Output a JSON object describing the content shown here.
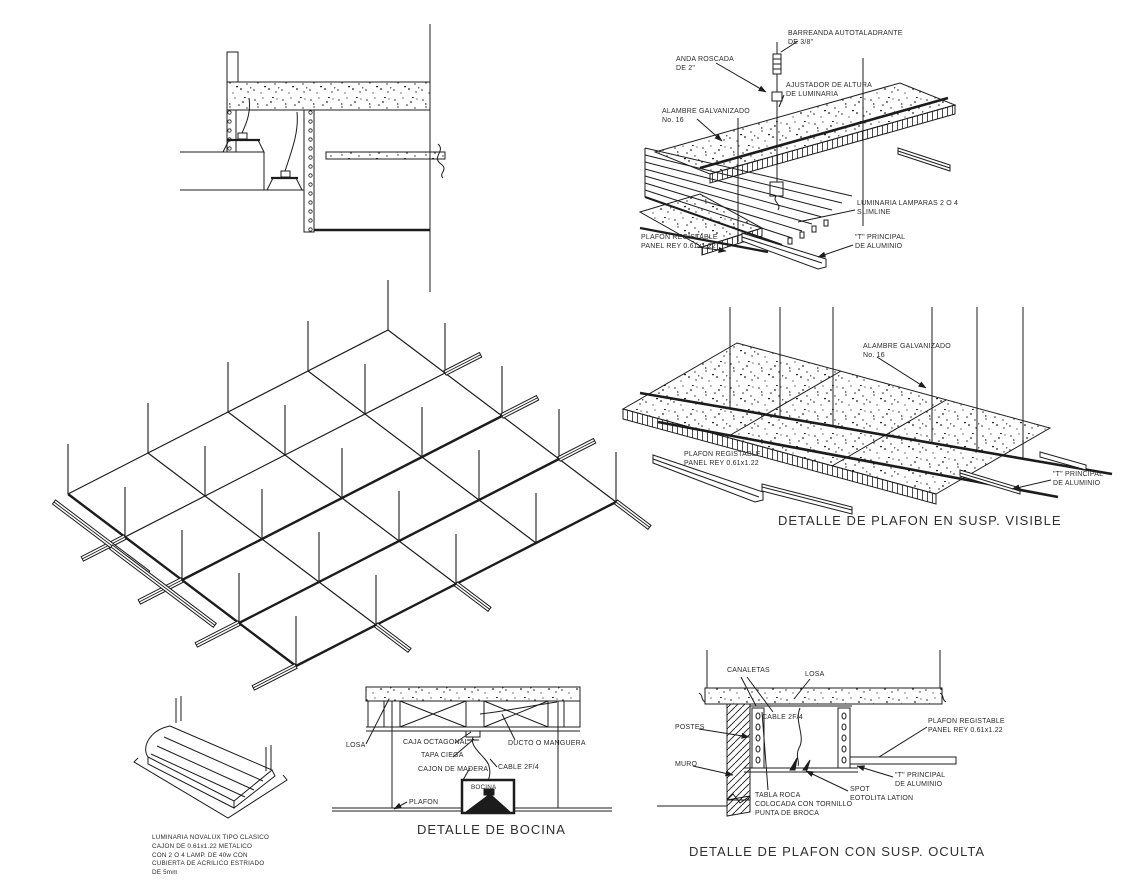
{
  "document": {
    "kind": "CAD ceiling construction details sheet (plafones)",
    "background": "#ffffff",
    "ink": "#1c1c1c"
  },
  "details": {
    "suspension_luminaria": {
      "labels": {
        "barrena": "BARREANDA AUTOTALADRANTE\nDE 3/8\"",
        "anda_roscada": "ANDA ROSCADA\nDE 2\"",
        "ajustador": "AJUSTADOR DE ALTURA\nDE LUMINARIA",
        "alambre": "ALAMBRE GALVANIZADO\nNo. 16",
        "luminaria_lamparas": "LUMINARIA LAMPARAS 2 O 4\nSLIMLINE",
        "plafon": "PLAFON REGISTABLE\nPANEL REY 0.61x1.22",
        "t_principal": "\"T\" PRINCIPAL\nDE ALUMINIO"
      }
    },
    "susp_visible": {
      "title": "DETALLE DE PLAFON EN SUSP. VISIBLE",
      "labels": {
        "alambre": "ALAMBRE GALVANIZADO\nNo. 16",
        "plafon": "PLAFON REGISTABLE\nPANEL REY 0.61x1.22",
        "t_principal": "\"T\" PRINCIPAL\nDE ALUMINIO"
      }
    },
    "bocina": {
      "title": "DETALLE DE BOCINA",
      "labels": {
        "losa": "LOSA",
        "caja_octagonal": "CAJA OCTAGONAL",
        "tapa_ciega": "TAPA CIEGA",
        "ducto": "DUCTO O MANGUERA",
        "cajon_madera": "CAJON DE MADERA",
        "cable": "CABLE 2F/4",
        "bocina": "BOCINA",
        "plafon": "PLAFON"
      }
    },
    "susp_oculta": {
      "title": "DETALLE DE PLAFON CON SUSP. OCULTA",
      "labels": {
        "canaletas": "CANALETAS",
        "losa": "LOSA",
        "cable": "CABLE 2F/4",
        "postes": "POSTES",
        "muro": "MURO",
        "tabla_roca": "TABLA ROCA\nCOLOCADA CON TORNILLO\nPUNTA DE BROCA",
        "spot": "SPOT\nEOTOLITA LATION",
        "plafon": "PLAFON REGISTABLE\nPANEL REY 0.61x1.22",
        "t_principal": "\"T\" PRINCIPAL\nDE ALUMINIO"
      }
    },
    "luminaria_iso": {
      "nota": "LUMINARIA NOVALUX TIPO CLASICO\nCAJON DE 0.61x1.22 METALICO\nCON 2 O 4 LAMP. DE 40w CON\nCUBIERTA DE ACRILICO ESTRIADO\nDE 5mm"
    }
  }
}
